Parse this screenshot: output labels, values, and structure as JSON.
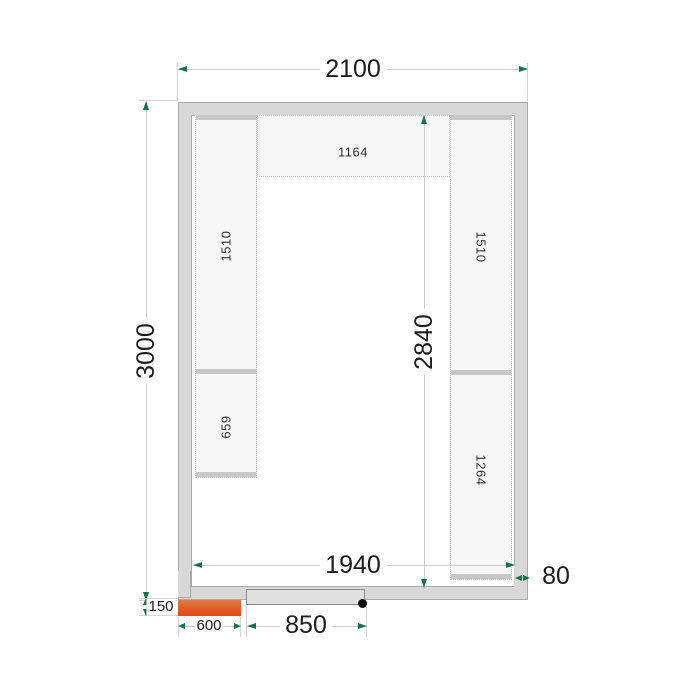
{
  "drawing": {
    "kind": "cold-room floor plan with shelving",
    "dimensions": {
      "outer_width": "2100",
      "outer_length": "3000",
      "inner_width": "1940",
      "inner_length": "2840",
      "wall_thickness": "80",
      "unit_offset": "150",
      "unit_width": "600",
      "door_width": "850"
    },
    "shelves": {
      "top_center": "1164",
      "left_upper": "1510",
      "left_lower": "659",
      "right_upper": "1510",
      "right_lower": "1264"
    },
    "colors": {
      "wall_fill": "#d8d8d8",
      "shelf_fill": "#f7f7f7",
      "dimension_arrow_green": "#157347",
      "unit_gradient_top": "#8cc5ba",
      "unit_gradient_bottom": "#e8450d",
      "door_fill": "#e0e0e0",
      "hinge_dot": "#0d0d0d"
    }
  }
}
